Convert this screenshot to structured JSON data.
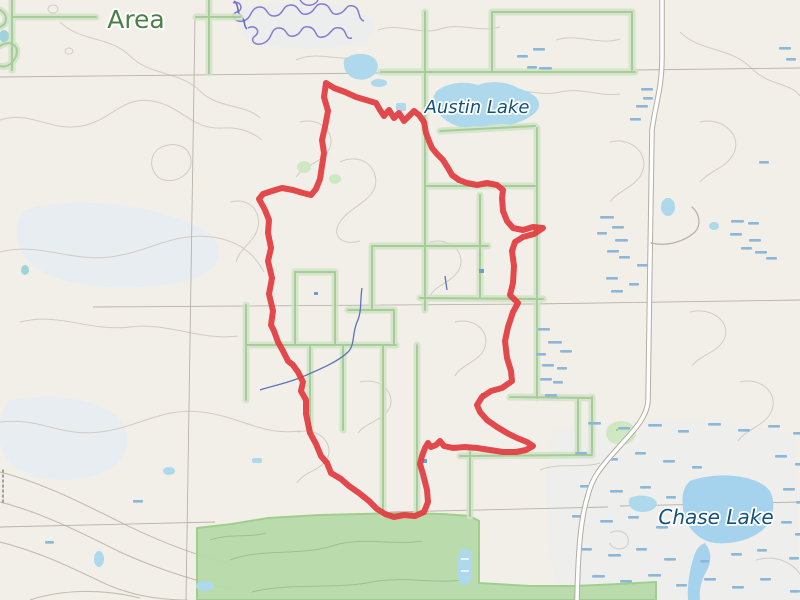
{
  "map": {
    "width": 800,
    "height": 600,
    "background": "#f2efe9",
    "labels": {
      "area": {
        "text": "Area",
        "color": "#4a8046"
      },
      "austin_lake": {
        "text": "Austin Lake",
        "color": "#14527d"
      },
      "chase_lake": {
        "text": "Chase Lake",
        "color": "#14527d"
      }
    },
    "colors": {
      "route": "#e23b3e",
      "water": "#aed8ec",
      "water_deep": "#a5d2ec",
      "water_teal": "#9fd4da",
      "wetland": "#8bb8d9",
      "stream": "#5b74b8",
      "marsh_outline": "#837bd0",
      "marsh_outline_dark": "#5f68c8",
      "boundary_band": "#cfe3c4",
      "boundary_line": "#9cc48e",
      "forest": "#b7dbaa",
      "forest_edge": "#9ccb8b",
      "road_fill": "#ffffff",
      "road_casing": "#b3ada2",
      "grid_line": "#b2aca1",
      "contour": "#d2ccc2",
      "contour_index": "#c3bcb0"
    },
    "route": {
      "width": 6,
      "points": [
        [
          326,
          83
        ],
        [
          334,
          88
        ],
        [
          345,
          92
        ],
        [
          356,
          97
        ],
        [
          366,
          100
        ],
        [
          376,
          103
        ],
        [
          380,
          110
        ],
        [
          384,
          116
        ],
        [
          389,
          110
        ],
        [
          394,
          118
        ],
        [
          399,
          113
        ],
        [
          404,
          121
        ],
        [
          409,
          116
        ],
        [
          414,
          111
        ],
        [
          419,
          115
        ],
        [
          424,
          122
        ],
        [
          426,
          133
        ],
        [
          429,
          141
        ],
        [
          432,
          148
        ],
        [
          437,
          154
        ],
        [
          443,
          160
        ],
        [
          448,
          168
        ],
        [
          452,
          175
        ],
        [
          459,
          180
        ],
        [
          467,
          183
        ],
        [
          477,
          185
        ],
        [
          487,
          183
        ],
        [
          497,
          185
        ],
        [
          503,
          190
        ],
        [
          502,
          198
        ],
        [
          503,
          211
        ],
        [
          507,
          221
        ],
        [
          513,
          228
        ],
        [
          523,
          230
        ],
        [
          533,
          227
        ],
        [
          543,
          228
        ],
        [
          534,
          234
        ],
        [
          523,
          237
        ],
        [
          515,
          242
        ],
        [
          512,
          251
        ],
        [
          514,
          266
        ],
        [
          513,
          283
        ],
        [
          510,
          295
        ],
        [
          518,
          303
        ],
        [
          513,
          312
        ],
        [
          508,
          327
        ],
        [
          505,
          341
        ],
        [
          507,
          358
        ],
        [
          511,
          371
        ],
        [
          512,
          381
        ],
        [
          502,
          388
        ],
        [
          491,
          391
        ],
        [
          482,
          397
        ],
        [
          477,
          405
        ],
        [
          480,
          412
        ],
        [
          487,
          420
        ],
        [
          497,
          427
        ],
        [
          507,
          433
        ],
        [
          517,
          438
        ],
        [
          527,
          442
        ],
        [
          533,
          446
        ],
        [
          526,
          450
        ],
        [
          516,
          452
        ],
        [
          503,
          452
        ],
        [
          490,
          450
        ],
        [
          477,
          448
        ],
        [
          465,
          447
        ],
        [
          453,
          448
        ],
        [
          444,
          446
        ],
        [
          440,
          441
        ],
        [
          436,
          445
        ],
        [
          431,
          447
        ],
        [
          428,
          443
        ],
        [
          425,
          448
        ],
        [
          422,
          456
        ],
        [
          420,
          464
        ],
        [
          423,
          474
        ],
        [
          427,
          490
        ],
        [
          428,
          502
        ],
        [
          424,
          512
        ],
        [
          415,
          516
        ],
        [
          404,
          515
        ],
        [
          394,
          517
        ],
        [
          385,
          514
        ],
        [
          377,
          509
        ],
        [
          369,
          501
        ],
        [
          359,
          493
        ],
        [
          349,
          486
        ],
        [
          341,
          479
        ],
        [
          331,
          473
        ],
        [
          327,
          463
        ],
        [
          321,
          456
        ],
        [
          316,
          444
        ],
        [
          310,
          433
        ],
        [
          306,
          414
        ],
        [
          306,
          400
        ],
        [
          301,
          391
        ],
        [
          303,
          382
        ],
        [
          298,
          372
        ],
        [
          293,
          365
        ],
        [
          288,
          361
        ],
        [
          283,
          351
        ],
        [
          278,
          342
        ],
        [
          274,
          331
        ],
        [
          271,
          325
        ],
        [
          273,
          311
        ],
        [
          269,
          294
        ],
        [
          272,
          278
        ],
        [
          268,
          261
        ],
        [
          271,
          248
        ],
        [
          268,
          233
        ],
        [
          269,
          220
        ],
        [
          265,
          210
        ],
        [
          259,
          199
        ],
        [
          263,
          194
        ],
        [
          272,
          191
        ],
        [
          282,
          188
        ],
        [
          293,
          190
        ],
        [
          303,
          193
        ],
        [
          311,
          195
        ],
        [
          316,
          189
        ],
        [
          320,
          179
        ],
        [
          322,
          166
        ],
        [
          324,
          153
        ],
        [
          322,
          140
        ],
        [
          325,
          127
        ],
        [
          328,
          111
        ],
        [
          324,
          97
        ],
        [
          326,
          83
        ]
      ]
    }
  }
}
